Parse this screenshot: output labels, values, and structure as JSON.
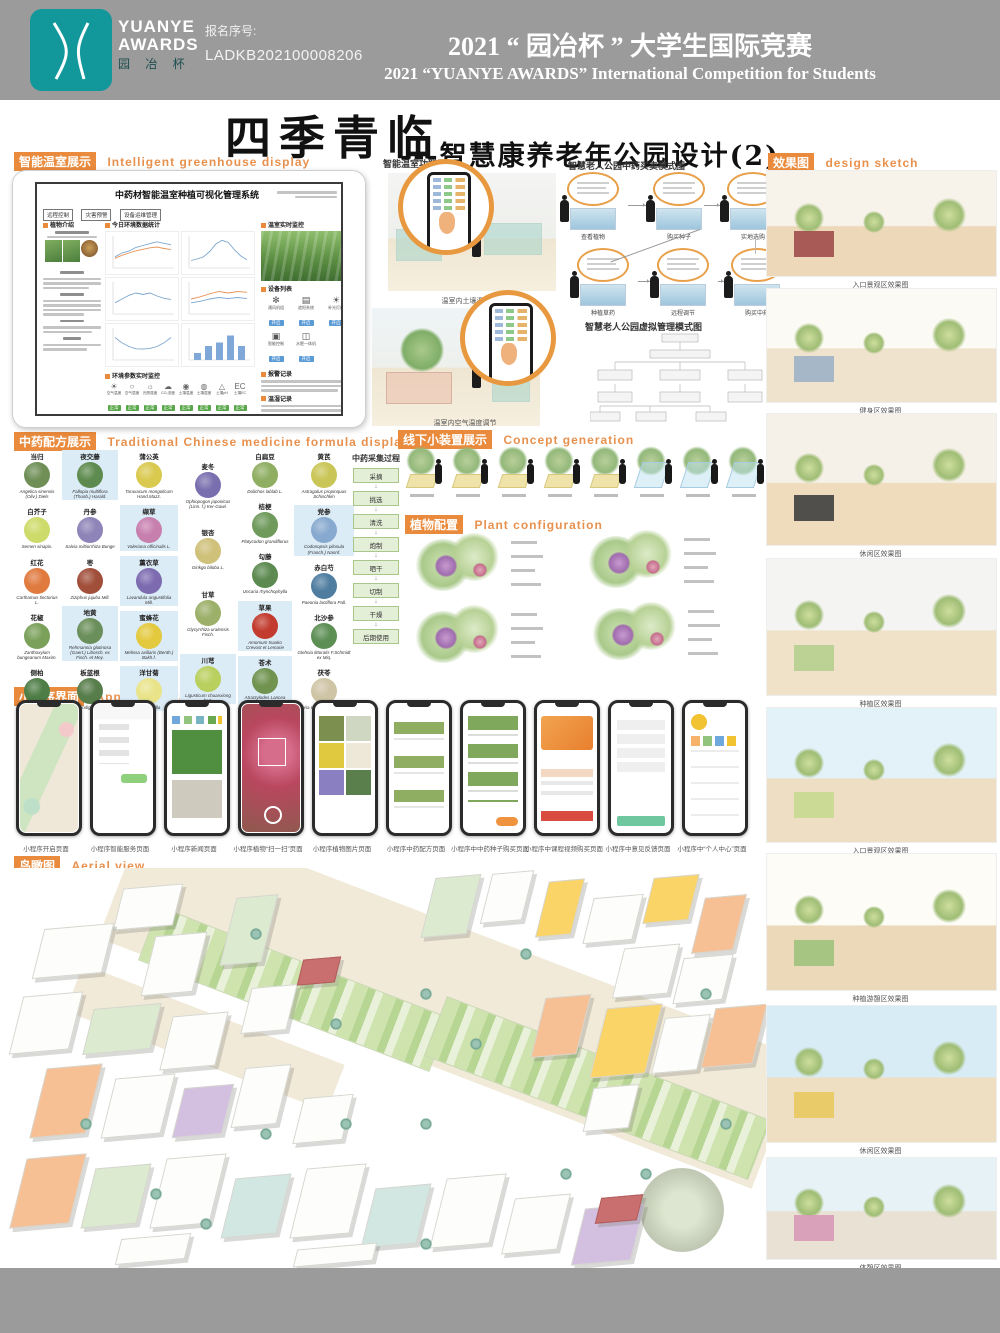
{
  "header": {
    "registration_label": "报名序号:",
    "registration_no": "LADKB202100008206",
    "title_cn": "2021 “ 园冶杯 ” 大学生国际竞赛",
    "title_en": "2021 “YUANYE AWARDS” International Competition for  Students",
    "logo": {
      "line1": "YUANYE",
      "line2": "AWARDS",
      "line3": "园 冶 杯"
    }
  },
  "main_title": {
    "cn": "四季青临",
    "sub": "---智慧康养老年公园设计(2)"
  },
  "sections": {
    "greenhouse": {
      "badge": "智能温室展示",
      "en": "Intelligent greenhouse display"
    },
    "formula": {
      "badge": "中药配方展示",
      "en": "Traditional Chinese medicine formula display"
    },
    "applet": {
      "badge": "小程序界面",
      "en": "Applet interface"
    },
    "aerial": {
      "badge": "鸟瞰图",
      "en": "Aerial view"
    },
    "sketch": {
      "badge": "效果图",
      "en": "design sketch"
    },
    "concept": {
      "badge": "线下小装置展示",
      "en": "Concept generation"
    },
    "plant_config": {
      "badge": "植物配置",
      "en": "Plant configuration"
    },
    "greenhouse_func": {
      "label": "智能温室功能展示",
      "captions": [
        "温室内土壤湿度调节",
        "温室内空气温度调节"
      ]
    },
    "trade_flow": {
      "title": "智慧老人公园中药买卖模式图",
      "steps": [
        {
          "caption": "查看植物"
        },
        {
          "caption": "购买种子"
        },
        {
          "caption": "实地选购"
        },
        {
          "caption": "种植草药"
        },
        {
          "caption": "远程调节"
        },
        {
          "caption": "购买中药"
        }
      ]
    },
    "mgmt": {
      "title": "智慧老人公园虚拟管理模式图"
    }
  },
  "dashboard": {
    "title": "中药材智能温室种植可视化管理系统",
    "buttons": [
      "远程控制",
      "灾害预警",
      "设备运维管理"
    ],
    "panels": {
      "plant_intro": "植物介绍",
      "daily": "今日环境数据统计",
      "env": "环境参数实时监控",
      "monitor": "温室实时监控",
      "devices": "设备列表",
      "alarm": "报警记录",
      "records": "温湿记录"
    },
    "device_action": "开启",
    "device_items": [
      {
        "name": "通风机组",
        "icon": "fan-icon",
        "glyph": "✻"
      },
      {
        "name": "遮阳系统",
        "icon": "shade-icon",
        "glyph": "▤"
      },
      {
        "name": "补光灯组",
        "icon": "lamp-icon",
        "glyph": "☀"
      },
      {
        "name": "智能控制",
        "icon": "controller-icon",
        "glyph": "▣"
      },
      {
        "name": "水肥一体机",
        "icon": "irrigation-icon",
        "glyph": "◫"
      }
    ],
    "env_status": "正常",
    "env_params": [
      {
        "label": "空气温度",
        "glyph": "☀"
      },
      {
        "label": "空气湿度",
        "glyph": "○"
      },
      {
        "label": "光照强度",
        "glyph": "☼"
      },
      {
        "label": "CO₂浓度",
        "glyph": "☁"
      },
      {
        "label": "土壤温度",
        "glyph": "◉"
      },
      {
        "label": "土壤湿度",
        "glyph": "◍"
      },
      {
        "label": "土壤pH",
        "glyph": "△"
      },
      {
        "label": "土壤EC",
        "glyph": "EC"
      }
    ],
    "charts": [
      {
        "el": "c1",
        "type": "line",
        "series": [
          {
            "color": "#7da7cf",
            "values": [
              3,
              4,
              4.5,
              5.5,
              6,
              6.5,
              7,
              6.6,
              6.2
            ]
          },
          {
            "color": "#e8935a",
            "values": [
              2.6,
              3.4,
              4,
              4.6,
              5,
              5.4,
              5.6,
              5.2,
              4.9
            ]
          }
        ]
      },
      {
        "el": "c2",
        "type": "line",
        "series": [
          {
            "color": "#7da7cf",
            "values": [
              2,
              2.4,
              3,
              4.4,
              6.4,
              7.4,
              6.8,
              4.8,
              3.2,
              2.2
            ]
          }
        ]
      },
      {
        "el": "c3",
        "type": "line",
        "series": [
          {
            "color": "#7da7cf",
            "values": [
              3,
              4,
              5,
              5.6,
              5.2,
              5.6,
              4.8,
              4.2,
              3.9
            ]
          }
        ]
      },
      {
        "el": "c4",
        "type": "line",
        "series": [
          {
            "color": "#e8935a",
            "values": [
              4,
              4.6,
              5.4,
              6,
              5.6,
              6,
              5.8
            ]
          },
          {
            "color": "#7da7cf",
            "values": [
              3,
              3.4,
              4,
              4.4,
              4.1,
              4.4,
              4.1
            ]
          }
        ]
      },
      {
        "el": "c5",
        "type": "line",
        "series": [
          {
            "color": "#7da7cf",
            "values": [
              6,
              4.6,
              3.6,
              3,
              2.9,
              3.1,
              3.6,
              4.6,
              6
            ]
          }
        ]
      },
      {
        "el": "c6",
        "type": "bar",
        "color": "#7fa8d9",
        "values": [
          2,
          4,
          5,
          7,
          4
        ]
      }
    ]
  },
  "harvest": {
    "title": "中药采集过程",
    "steps": [
      "采摘",
      "挑选",
      "清洗",
      "炮制",
      "晒干",
      "切制",
      "干燥",
      "后期使用"
    ]
  },
  "plants": {
    "columns": [
      [
        {
          "name": "当归",
          "latin": "Angelica sinensis (Oliv.) Diels",
          "c": "#6f8f57",
          "hl": false
        },
        {
          "name": "白芥子",
          "latin": "Semen sinapis.",
          "c": "#cddb6a",
          "hl": false
        },
        {
          "name": "红花",
          "latin": "Carthamus tinctorius L.",
          "c": "#e07a3f",
          "hl": false
        },
        {
          "name": "花椒",
          "latin": "Zanthoxylum bungeanum Maxim.",
          "c": "#7aa05a",
          "hl": false
        },
        {
          "name": "侧柏",
          "latin": "Platycladus orientalis (L.) Franco",
          "c": "#4e7d46",
          "hl": false
        }
      ],
      [
        {
          "name": "夜交藤",
          "latin": "Fallopia multiflora (Thunb.) Harald.",
          "c": "#5d8a4e",
          "hl": true
        },
        {
          "name": "丹参",
          "latin": "Salvia miltiorrhiza Bunge",
          "c": "#8e84b8",
          "hl": false
        },
        {
          "name": "枣",
          "latin": "Ziziphus jujuba Mill.",
          "c": "#a14f3a",
          "hl": false
        },
        {
          "name": "地黄",
          "latin": "Rehmannia glutinosa (Gaert.) Libosch. ex Fisch. et Mey.",
          "c": "#6b8f5a",
          "hl": true
        },
        {
          "name": "板蓝根",
          "latin": "Isatis indigotica Fort.",
          "c": "#577d4b",
          "hl": false
        }
      ],
      [
        {
          "name": "蒲公英",
          "latin": "Taraxacum mongolicum Hand.Mazz.",
          "c": "#d9c94f",
          "hl": false
        },
        {
          "name": "缬草",
          "latin": "Valeriana officinalis L.",
          "c": "#c77fae",
          "hl": true
        },
        {
          "name": "薰衣草",
          "latin": "Lavandula angustifolia Mill.",
          "c": "#7d6bb0",
          "hl": true
        },
        {
          "name": "蜜蜂花",
          "latin": "Melissa axillaris (Benth.) Bakh.f.",
          "c": "#e3c93e",
          "hl": true
        },
        {
          "name": "洋甘菊",
          "latin": "chamomilla",
          "c": "#e9e48a",
          "hl": true
        }
      ],
      [
        {
          "name": "麦冬",
          "latin": "Ophiopogon japonicus (Linn. f.) Ker-Gawl.",
          "c": "#7a6fae",
          "hl": false
        },
        {
          "name": "银杏",
          "latin": "Ginkgo biloba L.",
          "c": "#cfc07a",
          "hl": false
        },
        {
          "name": "甘草",
          "latin": "Glycyrrhiza uralensis Fisch.",
          "c": "#9cb06a",
          "hl": false
        },
        {
          "name": "川芎",
          "latin": "Ligusticum chuanxiong hort.",
          "c": "#b9cf5e",
          "hl": true
        }
      ],
      [
        {
          "name": "白扁豆",
          "latin": "Dolichos lablab L.",
          "c": "#8fae62",
          "hl": false
        },
        {
          "name": "桔梗",
          "latin": "Platycodon grandiflorus",
          "c": "#6f9a5c",
          "hl": false
        },
        {
          "name": "勾藤",
          "latin": "Uncaria rhynchophylla",
          "c": "#5c8a50",
          "hl": false
        },
        {
          "name": "草果",
          "latin": "Amomum tsaoko Crevost et Lemarie",
          "c": "#c23b2e",
          "hl": true
        },
        {
          "name": "苍术",
          "latin": "Atractylodes Lancea (Thunb.) DC.",
          "c": "#70934f",
          "hl": true
        }
      ],
      [
        {
          "name": "黄芪",
          "latin": "Astragalus propinquus Schischkin",
          "c": "#c9c557",
          "hl": false
        },
        {
          "name": "党参",
          "latin": "Codonopsis pilosula (Franch.) Nannf.",
          "c": "#88a9cf",
          "hl": true
        },
        {
          "name": "赤白芍",
          "latin": "Paeonia lactiflora Pall.",
          "c": "#4f7da0",
          "hl": false
        },
        {
          "name": "北沙参",
          "latin": "Glehnia littoralis F.Schmidt ex Miq.",
          "c": "#5d8f55",
          "hl": false
        },
        {
          "name": "茯苓",
          "latin": "Poria cocos (Schw.) Wolf",
          "c": "#cfc4a6",
          "hl": false
        }
      ]
    ]
  },
  "phones": [
    {
      "caption": "小程序开启页面",
      "variant": "map"
    },
    {
      "caption": "小程序智能服务页面",
      "variant": "chat"
    },
    {
      "caption": "小程序新闻页面",
      "variant": "news"
    },
    {
      "caption": "小程序植物“扫一扫”页面",
      "variant": "scan"
    },
    {
      "caption": "小程序植物图片页面",
      "variant": "gallery"
    },
    {
      "caption": "小程序中药配方页面",
      "variant": "formula"
    },
    {
      "caption": "小程序中中药种子购买页面",
      "variant": "seeds"
    },
    {
      "caption": "小程序中课程视频购买页面",
      "variant": "pay"
    },
    {
      "caption": "小程序中意见反馈页面",
      "variant": "feedback"
    },
    {
      "caption": "小程序中“个人中心”页面",
      "variant": "profile"
    }
  ],
  "renders": [
    {
      "caption": "入口景观区效果图",
      "sky": "#f7f3ea",
      "ground": "#edd9ba",
      "accent": "#a04b4b"
    },
    {
      "caption": "健身区效果图",
      "sky": "#fbfaf4",
      "ground": "#f0e3cd",
      "accent": "#9db3c6"
    },
    {
      "caption": "休闲区效果图",
      "sky": "#f6f1e8",
      "ground": "#eedcbd",
      "accent": "#3f3f3f"
    },
    {
      "caption": "种植区效果图",
      "sky": "#f4f4f2",
      "ground": "#efe2c9",
      "accent": "#b6cf8e"
    },
    {
      "caption": "入口景观区效果图",
      "sky": "#e3f1f8",
      "ground": "#eedfc4",
      "accent": "#c6d98f"
    },
    {
      "caption": "种植游憩区效果图",
      "sky": "#fdfcf7",
      "ground": "#ecd9b9",
      "accent": "#9ec27c"
    },
    {
      "caption": "休闲区效果图",
      "sky": "#d8ecf6",
      "ground": "#eedfc2",
      "accent": "#e8c95f"
    },
    {
      "caption": "体憩区效果图",
      "sky": "#e7f2f7",
      "ground": "#e9e2d4",
      "accent": "#d89ab8"
    }
  ]
}
